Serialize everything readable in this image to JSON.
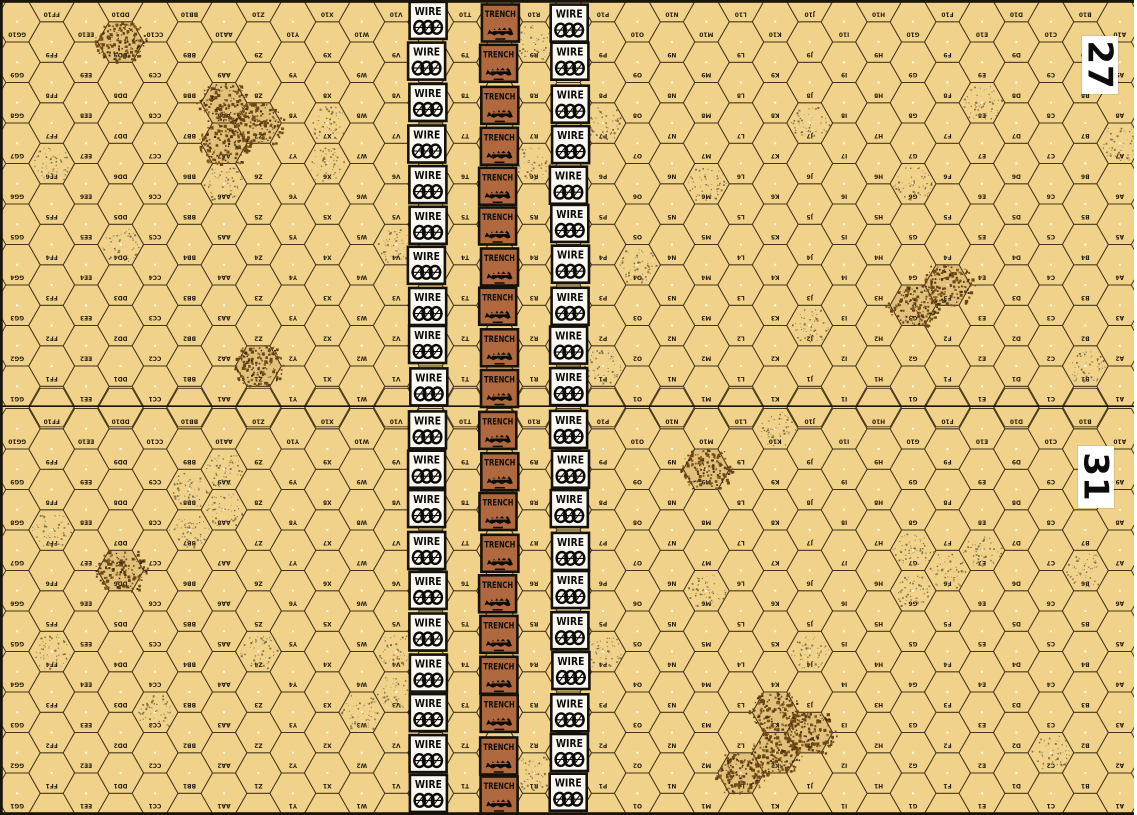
{
  "map": {
    "width": 1137,
    "height": 815,
    "boards": [
      {
        "number": "27",
        "panel": {
          "x": 1082,
          "y": 36,
          "w": 36,
          "h": 58
        }
      },
      {
        "number": "31",
        "panel": {
          "x": 1078,
          "y": 446,
          "w": 36,
          "h": 62
        }
      }
    ],
    "grid": {
      "columns": 33,
      "rows_per_board": 10,
      "column_letters_left_to_right": [
        "GG",
        "FF",
        "EE",
        "DD",
        "CC",
        "BB",
        "AA",
        "Z",
        "Y",
        "X",
        "W",
        "V",
        "U",
        "T",
        "S",
        "R",
        "Q",
        "P",
        "O",
        "N",
        "M",
        "L",
        "K",
        "J",
        "I",
        "H",
        "G",
        "F",
        "E",
        "D",
        "C",
        "B",
        "A"
      ],
      "row_numbers_top_to_bottom": [
        10,
        9,
        8,
        7,
        6,
        5,
        4,
        3,
        2,
        1
      ],
      "orientation_note": "boards rotated 180 degrees - hex labels appear upside down"
    },
    "counters": {
      "wire_label": "WIRE",
      "trench_label": "TRENCH",
      "rows_per_board": 10,
      "columns": [
        {
          "type": "wire",
          "hex_column": "U",
          "x": 427.5
        },
        {
          "type": "trench",
          "hex_column": "S",
          "x": 499.0
        },
        {
          "type": "wire",
          "hex_column": "Q",
          "x": 569.5
        }
      ]
    },
    "terrain_patches": {
      "dark": [
        [
          110,
          39
        ],
        [
          215,
          100
        ],
        [
          251,
          117
        ],
        [
          214,
          142
        ],
        [
          248,
          367
        ],
        [
          961,
          284
        ],
        [
          924,
          306
        ],
        [
          109,
          568
        ],
        [
          712,
          468
        ],
        [
          783,
          714
        ],
        [
          825,
          735
        ],
        [
          782,
          754
        ],
        [
          750,
          773
        ]
      ],
      "light": [
        [
          534,
          40
        ],
        [
          996,
          102
        ],
        [
          320,
          122
        ],
        [
          606,
          123
        ],
        [
          821,
          124
        ],
        [
          528,
          150
        ],
        [
          37,
          162
        ],
        [
          322,
          160
        ],
        [
          1103,
          163
        ],
        [
          214,
          181
        ],
        [
          713,
          183
        ],
        [
          927,
          183
        ],
        [
          108,
          242
        ],
        [
          389,
          241
        ],
        [
          637,
          265
        ],
        [
          820,
          327
        ],
        [
          607,
          367
        ],
        [
          1101,
          363
        ],
        [
          783,
          426
        ],
        [
          215,
          467
        ],
        [
          180,
          489
        ],
        [
          215,
          512
        ],
        [
          180,
          530
        ],
        [
          38,
          530
        ],
        [
          927,
          551
        ],
        [
          994,
          550
        ],
        [
          963,
          573
        ],
        [
          1101,
          570
        ],
        [
          926,
          590
        ],
        [
          713,
          591
        ],
        [
          607,
          650
        ],
        [
          819,
          651
        ],
        [
          38,
          652
        ],
        [
          250,
          652
        ],
        [
          391,
          654
        ],
        [
          391,
          695
        ],
        [
          363,
          711
        ],
        [
          148,
          713
        ],
        [
          1067,
          754
        ],
        [
          534,
          770
        ]
      ]
    },
    "colors": {
      "board_bg": "#f1d28a",
      "grid_line": "#42351a",
      "hex_label": "#241c0e",
      "white_dot": "#ffffff",
      "wire_counter_bg": "#faf8f3",
      "trench_counter_bg": "#b0693f",
      "counter_border": "#15120c",
      "counter_text": "#0d0b08",
      "speck_dark_1": "#6b4716",
      "speck_dark_2": "#3f2a08",
      "speck_dark_3": "#8a5f1e",
      "speck_light_1": "#7c6a3a",
      "speck_light_2": "#8a8570",
      "dark_patch_tint": "rgba(120,85,25,0.13)",
      "board_frame": "#1a150c",
      "panel_bg": "#ffffff",
      "panel_text": "#0c0c0c"
    }
  }
}
